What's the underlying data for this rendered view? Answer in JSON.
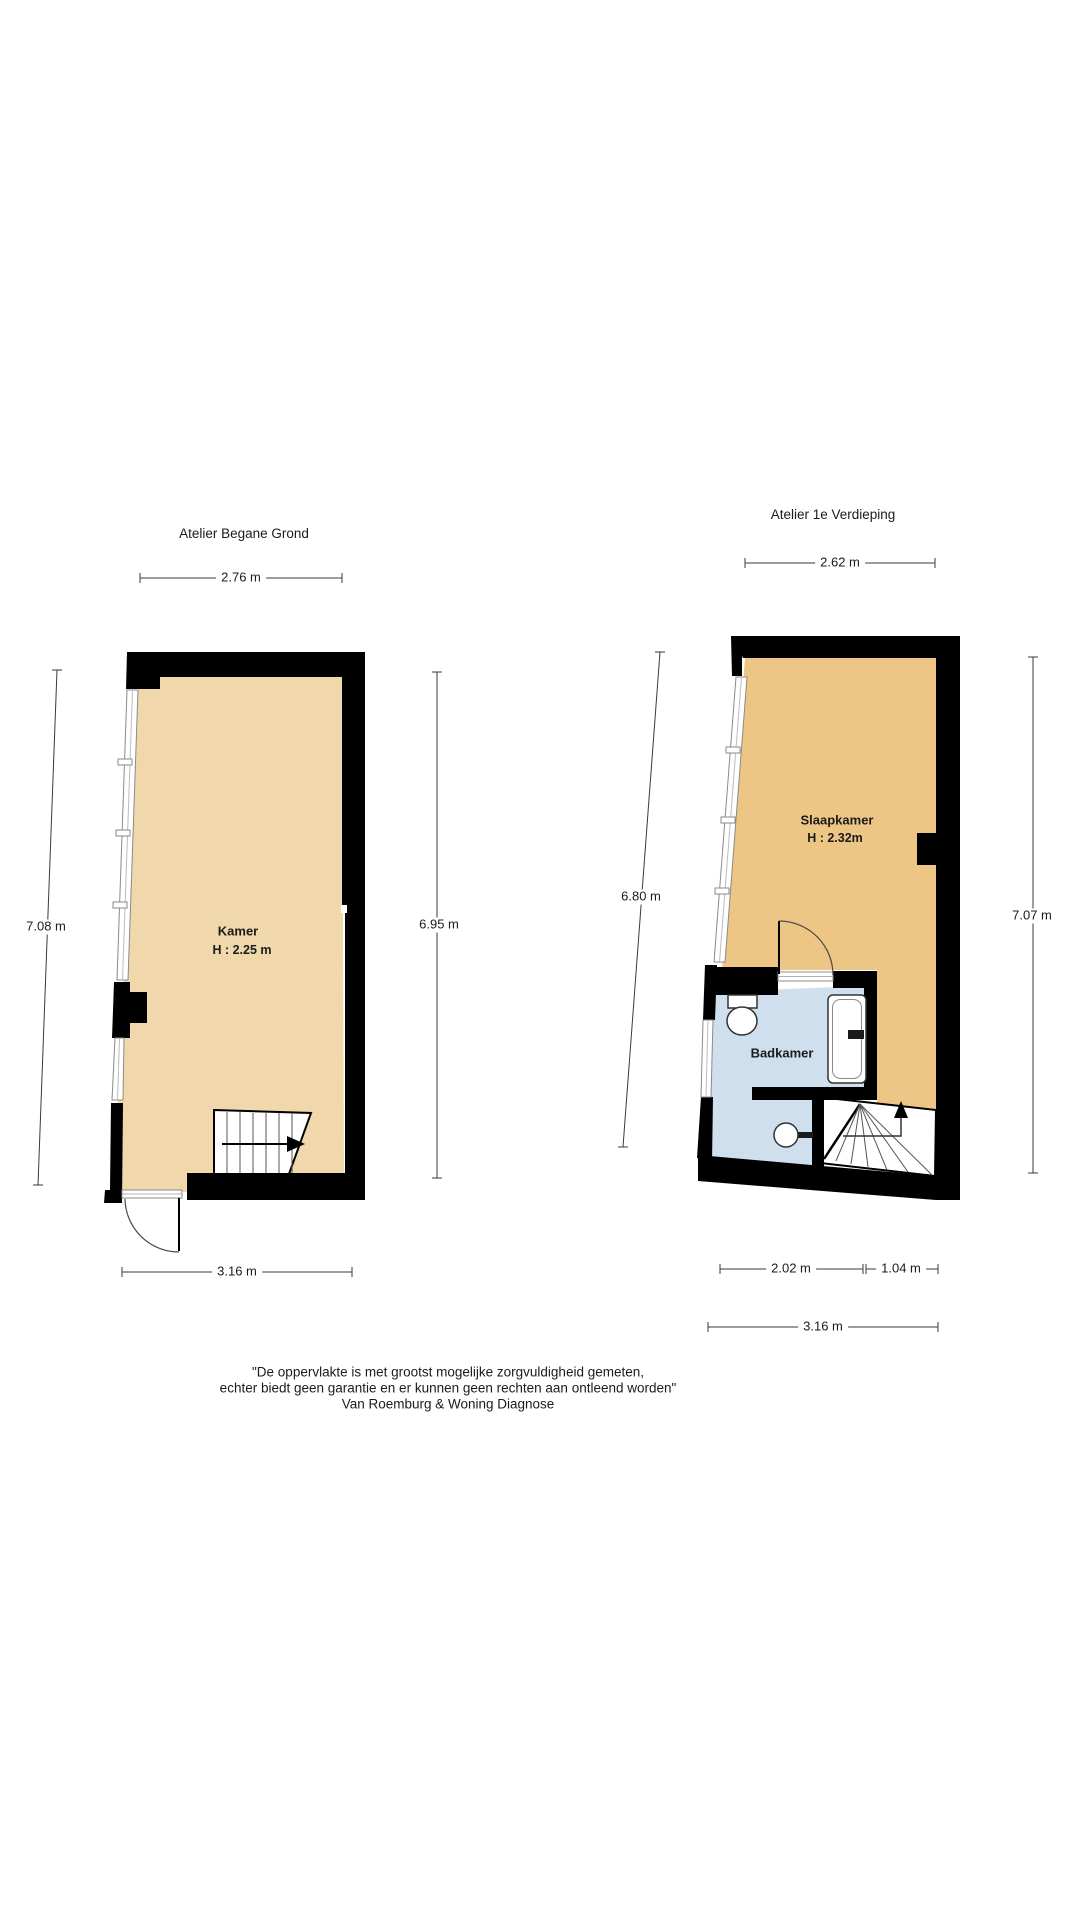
{
  "document": {
    "type": "floorplan-sheet",
    "background": "#ffffff"
  },
  "colors": {
    "wall": "#000000",
    "floor_ground": "#f1d8ac",
    "floor_first": "#edc685",
    "bathroom": "#cfdfed",
    "dimension": "#3a3a3a",
    "window_frame": "#8a8a8a",
    "stair_line": "#555555"
  },
  "plans": [
    {
      "title": "Atelier Begane Grond",
      "dims": {
        "top": "2.76 m",
        "left": "7.08 m",
        "right": "6.95 m",
        "bottom": "3.16 m"
      },
      "rooms": [
        {
          "name": "Kamer",
          "height": "H : 2.25 m"
        }
      ]
    },
    {
      "title": "Atelier 1e Verdieping",
      "dims": {
        "top": "2.62 m",
        "left": "6.80 m",
        "right": "7.07 m",
        "bottom_left": "2.02 m",
        "bottom_right": "1.04 m",
        "bottom_total": "3.16 m"
      },
      "rooms": [
        {
          "name": "Slaapkamer",
          "height": "H : 2.32m"
        },
        {
          "name": "Badkamer"
        }
      ]
    }
  ],
  "footer": {
    "line1": "\"De oppervlakte is met grootst mogelijke zorgvuldigheid gemeten,",
    "line2": "echter biedt geen garantie en er kunnen geen rechten aan ontleend worden\"",
    "line3": "Van Roemburg & Woning Diagnose"
  }
}
